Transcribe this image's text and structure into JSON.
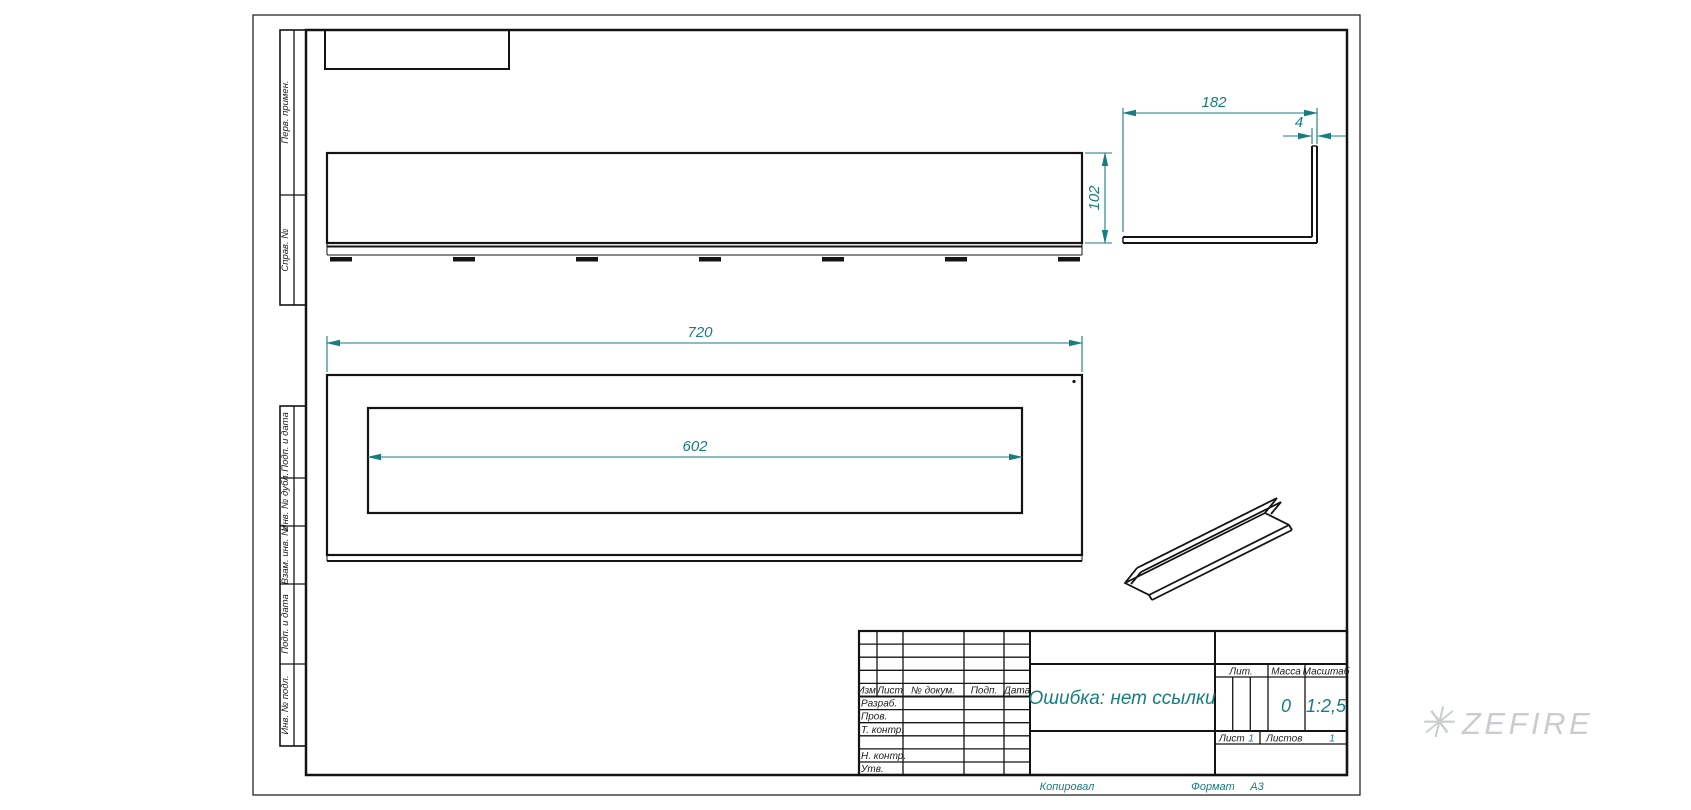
{
  "dims": {
    "d182": "182",
    "d4": "4",
    "d102": "102",
    "d720": "720",
    "d602": "602"
  },
  "left_strip": [
    "Перв. примен.",
    "Справ. №",
    "Подп. и дата",
    "Инв. № дубл.",
    "Взам. инв. №",
    "Подп. и дата",
    "Инв. № подл."
  ],
  "tb": {
    "izm": "Изм.",
    "list": "Лист",
    "ndok": "№ докум.",
    "podp": "Подп.",
    "data": "Дата",
    "razrab": "Разраб.",
    "prov": "Пров.",
    "tkontr": "Т. контр.",
    "nkontr": "Н. контр.",
    "utv": "Утв.",
    "name": "Ошибка: нет ссылки",
    "lit": "Лит.",
    "massa": "Масса",
    "masshtab": "Масштаб",
    "massa_val": "0",
    "scale_val": "1:2,5",
    "list_lbl": "Лист",
    "list_val": "1",
    "listov_lbl": "Листов",
    "listov_val": "1"
  },
  "footer": {
    "kopiroval": "Копировал",
    "format_lbl": "Формат",
    "format_val": "А3"
  },
  "watermark": {
    "flake": "✳",
    "text": "ZEFIRE"
  },
  "colors": {
    "dimension": "#177d7e",
    "line": "#141414",
    "watermark": "#c9cdd0"
  }
}
